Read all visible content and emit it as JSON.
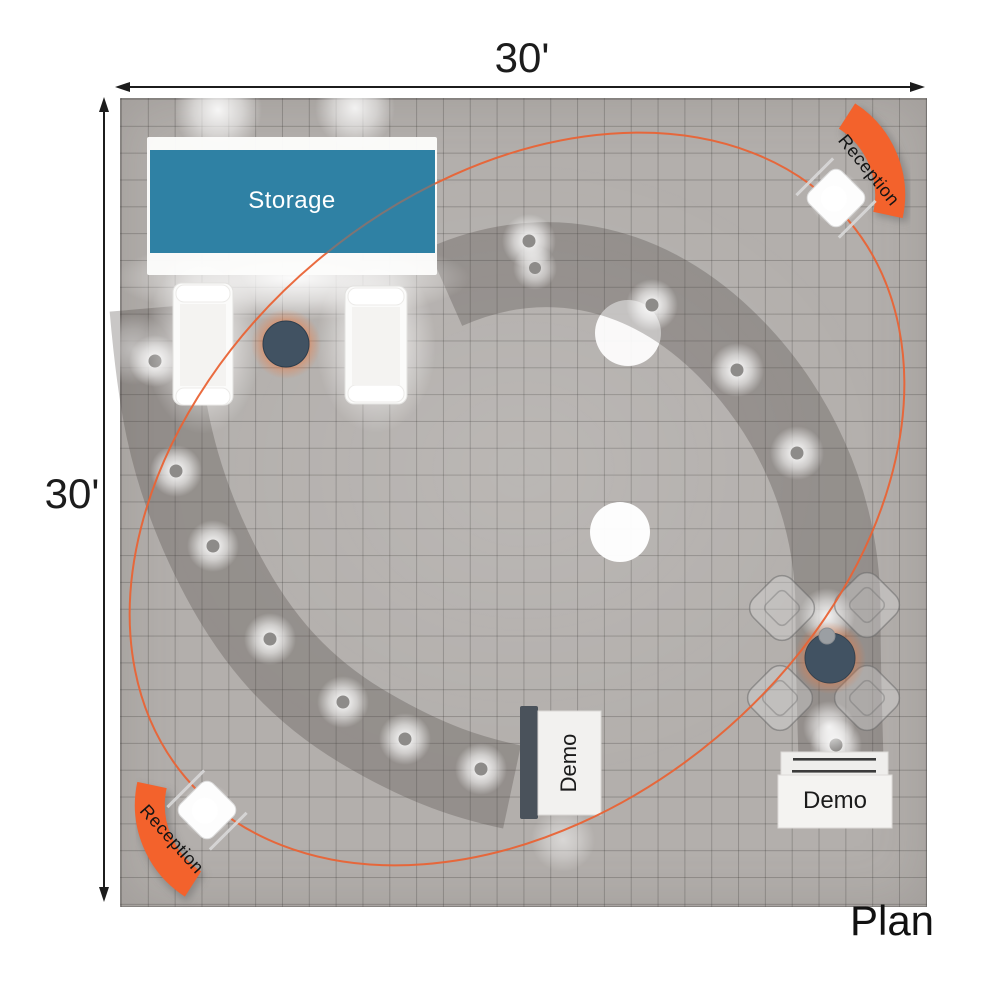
{
  "plan_label": "Plan",
  "dimensions": {
    "horizontal": "30'",
    "vertical": "30'"
  },
  "areas": {
    "storage": "Storage",
    "reception_top_right": "Reception",
    "reception_bottom_left": "Reception",
    "demo_center": "Demo",
    "demo_right": "Demo"
  },
  "colors": {
    "accent_orange": "#f3622c",
    "ellipse_orange": "#e96335",
    "storage_blue": "#2f81a4",
    "table_slate": "#415262",
    "floor_gray": "#b3afac",
    "band_gray": "rgba(75,70,66,0.30)"
  }
}
